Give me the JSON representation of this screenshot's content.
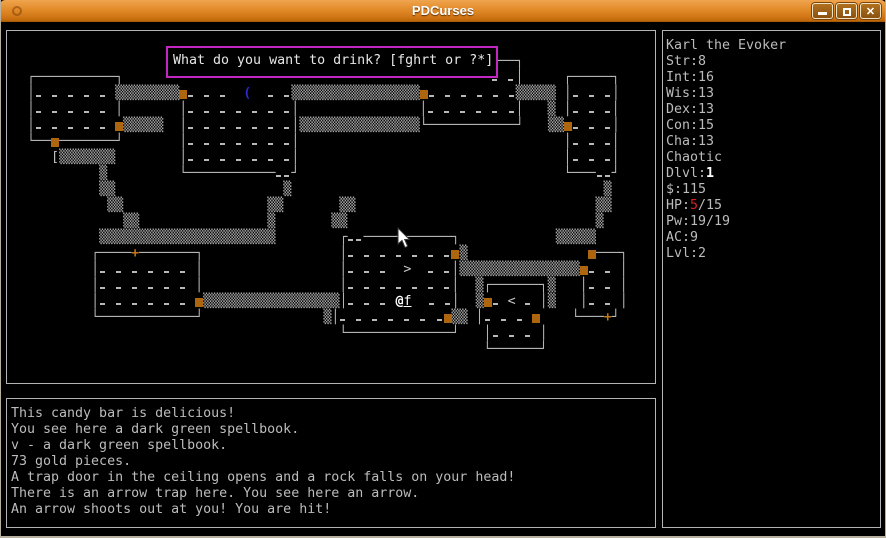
{
  "window": {
    "title": "PDCurses",
    "controls": {
      "minimize": "minimize",
      "maximize": "maximize",
      "close": "close"
    }
  },
  "prompt": {
    "text": "What do you want to drink? [fghrt or ?*]"
  },
  "map": {
    "rows": [
      "",
      "",
      "                                                    ┌───────────┐",
      "   ┌──────────┐                                              · ·│     ┌─────┐",
      "   │· · · · · ▒▒▒▒▒▒▒▒■· · ·  (  · ·▒▒▒▒▒▒▒▒▒▒▒▒▒▒▒▒■· · · · · ·▒▒▒▒▒ │· · ·│",
      "   │· · · · · │       │· · · · · · ·│               │· · · · · ·│   ▒ │· · ·│",
      "   │· · · · · ■▒▒▒▒▒  │· · · · · · ·│▒▒▒▒▒▒▒▒▒▒▒▒▒▒▒└───────────┘   ▒▒■· · ·│",
      "   └──■───────┘       │· · · · · · ·│                                 │· · ·│",
      "      [▒▒▒▒▒▒▒        │· · · · · · ·│                                 │· · ·│",
      "            ▒         └───────────··┘                                 └───··┘",
      "            ▒▒                     ▒                                       ▒",
      "             ▒▒                  ▒▒       ▒▒                              ▒▒",
      "               ▒▒                ▒       ▒▒                               ▒",
      "            ▒▒▒▒▒▒▒▒▒▒▒▒▒▒▒▒▒▒▒▒▒▒        ┌··───────────┐            ▒▒▒▒▒",
      "           ┌────+───────┐                 │· · · · · · ·■▒               ■───┐",
      "           │· · · · · · │                 │· · ·  >  · ·│▒▒▒▒▒▒▒▒▒▒▒▒▒▒▒■· · │",
      "           │· · · · · · │                 │· · · · · · ·│  ▒┌──────┐▒   │· · │",
      "           │· · · · · · ■▒▒▒▒▒▒▒▒▒▒▒▒▒▒▒▒▒│· · · @f  · ·│  ▒■· < · │▒   │· · │",
      "           └────────────┘               ▒│· · · · · · ·■▒▒ │· · · ■    └───+┘",
      "                                          └─────────────┘   │· · · │",
      "                                                            └──────┘",
      ""
    ]
  },
  "status": {
    "name": "Karl the Evoker",
    "attrs": [
      "Str:8",
      "Int:16",
      "Wis:13",
      "Dex:13",
      "Con:15",
      "Cha:13",
      "Chaotic"
    ],
    "dlvl": {
      "label": "Dlvl:",
      "value": "1"
    },
    "gold": "$:115",
    "hp": {
      "label": "HP:",
      "value": "5",
      "rest": "/15"
    },
    "pw": "Pw:19/19",
    "ac": "AC:9",
    "lvl": "Lvl:2"
  },
  "messages": {
    "lines": [
      "This candy bar is delicious!",
      "You see here a dark green spellbook.",
      "v - a dark green spellbook.",
      "73 gold pieces.",
      "A trap door in the ceiling opens and a rock falls on your head!",
      "There is an arrow trap here. You see here an arrow.",
      "An arrow shoots out at you! You are hit!"
    ]
  },
  "colors": {
    "titlebar_accent": "#e18a28",
    "door_orange": "#ad660f",
    "item_blue": "#2b2bd0",
    "hp_warning_red": "#d42222",
    "prompt_border_magenta": "#c326c3",
    "text_gray": "#bcbcbc",
    "bright_white": "#ffffff",
    "panel_border_gray": "#b4b4b4"
  }
}
